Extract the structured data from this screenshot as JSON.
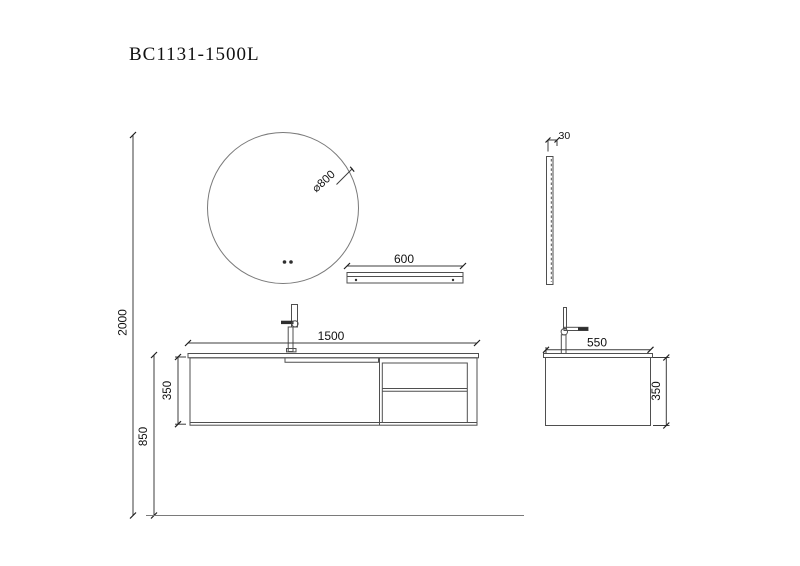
{
  "title": "BC1131-1500L",
  "colors": {
    "background": "#ffffff",
    "line": "#4f4f4f",
    "dimension_text": "#111111"
  },
  "views": {
    "mirror_front": {
      "diameter": "⌀800"
    },
    "shelf": {
      "width": "600"
    },
    "mirror_side": {
      "thickness": "30"
    },
    "vanity_front": {
      "width": "1500",
      "height": "350"
    },
    "vanity_side": {
      "depth": "550",
      "height": "350"
    },
    "elevation": {
      "total_height": "2000",
      "floor_to_counter": "850"
    }
  }
}
